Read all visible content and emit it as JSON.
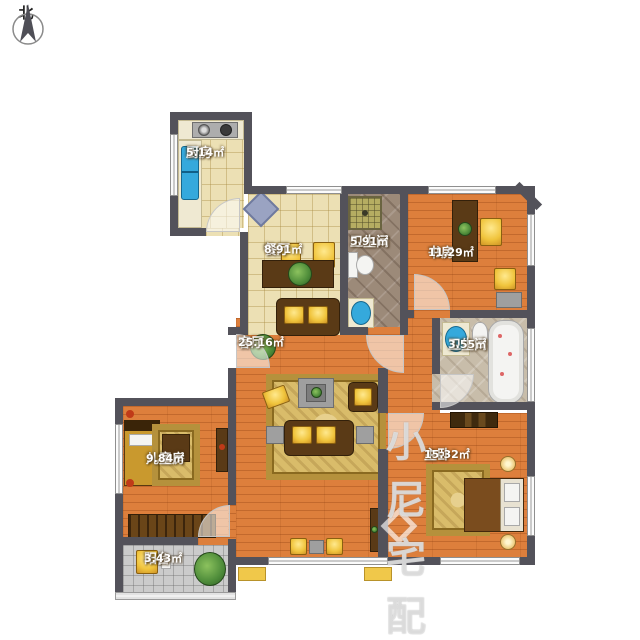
{
  "compass": {
    "label": "北"
  },
  "watermark": {
    "text": "小尼宅配"
  },
  "rooms": [
    {
      "id": "kitchen",
      "name": "厨房",
      "area": "5.14㎡"
    },
    {
      "id": "dining",
      "name": "餐厅",
      "area": "8.91㎡"
    },
    {
      "id": "bath1",
      "name": "卫生间",
      "area": "5.91㎡"
    },
    {
      "id": "study",
      "name": "书房",
      "area": "11.29㎡"
    },
    {
      "id": "bath2",
      "name": "卫生间",
      "area": "3.55㎡"
    },
    {
      "id": "living",
      "name": "客厅",
      "area": "25.16㎡"
    },
    {
      "id": "child",
      "name": "儿童房",
      "area": "9.84㎡"
    },
    {
      "id": "master",
      "name": "主卧",
      "area": "15.32㎡"
    },
    {
      "id": "balcony",
      "name": "阳台",
      "area": "3.43㎡"
    }
  ],
  "colors": {
    "wall": "#53525a",
    "wood_floor": "#dd7f3c",
    "cream_tile": "#ece0b4",
    "dark_marble": "#9c8a79",
    "light_marble": "#c8bdaa",
    "balcony_tile": "#cbcbcb",
    "accent_yellow": "#f0c43c",
    "sink_blue": "#35a9dc"
  }
}
